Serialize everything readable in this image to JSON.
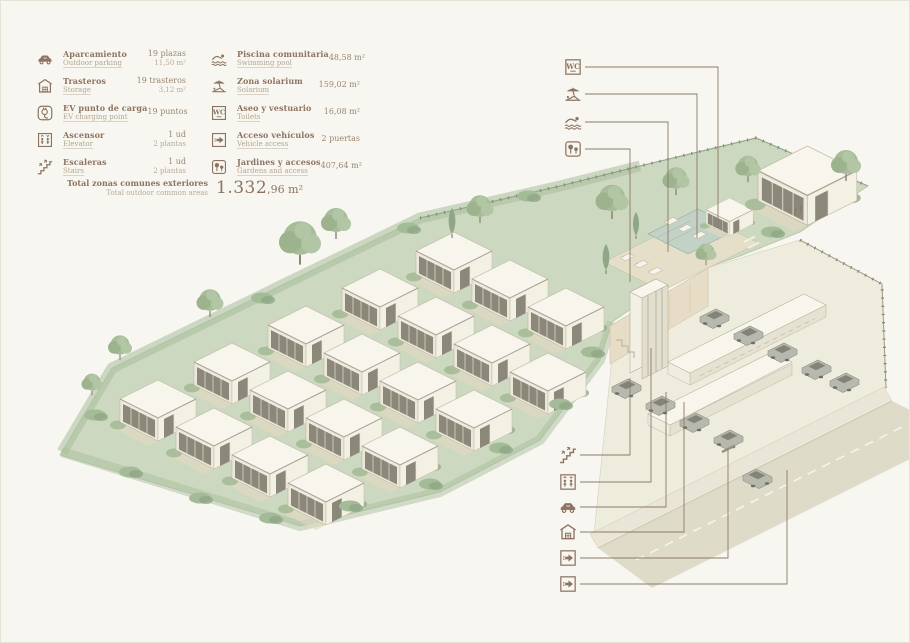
{
  "legend": {
    "col1": [
      {
        "icon": "car-icon",
        "label": "Aparcamiento",
        "sublabel": "Outdoor parking",
        "value1": "19 plazas",
        "value2": "11,50 m²"
      },
      {
        "icon": "storage-icon",
        "label": "Trasteros",
        "sublabel": "Storage",
        "value1": "19 trasteros",
        "value2": "3,12 m²"
      },
      {
        "icon": "ev-charger-icon",
        "label": "EV punto de carga",
        "sublabel": "EV charging point",
        "value1": "19 puntos",
        "value2": ""
      },
      {
        "icon": "elevator-icon",
        "label": "Ascensor",
        "sublabel": "Elevator",
        "value1": "1 ud",
        "value2": "2 plantas"
      },
      {
        "icon": "stairs-icon",
        "label": "Escaleras",
        "sublabel": "Stairs",
        "value1": "1 ud",
        "value2": "2 plantas"
      }
    ],
    "col2": [
      {
        "icon": "pool-icon",
        "label": "Piscina comunitaria",
        "sublabel": "Swimming pool",
        "value1": "48,58 m²",
        "value2": ""
      },
      {
        "icon": "solarium-icon",
        "label": "Zona solarium",
        "sublabel": "Solarium",
        "value1": "159,02 m²",
        "value2": ""
      },
      {
        "icon": "wc-icon",
        "label": "Aseo y vestuario",
        "sublabel": "Toilets",
        "value1": "16,08 m²",
        "value2": ""
      },
      {
        "icon": "vehicle-access-icon",
        "label": "Acceso vehículos",
        "sublabel": "Vehicle access",
        "value1": "2 puertas",
        "value2": ""
      },
      {
        "icon": "garden-icon",
        "label": "Jardines y accesos",
        "sublabel": "Gardens and access",
        "value1": "407,64 m²",
        "value2": ""
      }
    ],
    "total": {
      "label": "Total zonas comunes exteriores",
      "sublabel": "Total outdoor common areas",
      "value": "1.332,96 m²",
      "value_major": "1.332",
      "value_minor": ",96 m²"
    }
  },
  "callouts": {
    "top": [
      "wc-icon",
      "solarium-icon",
      "pool-icon",
      "garden-icon"
    ],
    "bottom": [
      "stairs-icon",
      "elevator-icon",
      "car-icon",
      "storage-icon",
      "vehicle-access-icon",
      "vehicle-access-icon"
    ]
  },
  "icons": {
    "wc_glyph": "WC"
  },
  "colors": {
    "ink": "#8d7462",
    "ink_light": "#b5a68f",
    "callout_line": "#8c7a66",
    "site_green": "#ccd8c0",
    "paper": "#f8f6f0"
  }
}
